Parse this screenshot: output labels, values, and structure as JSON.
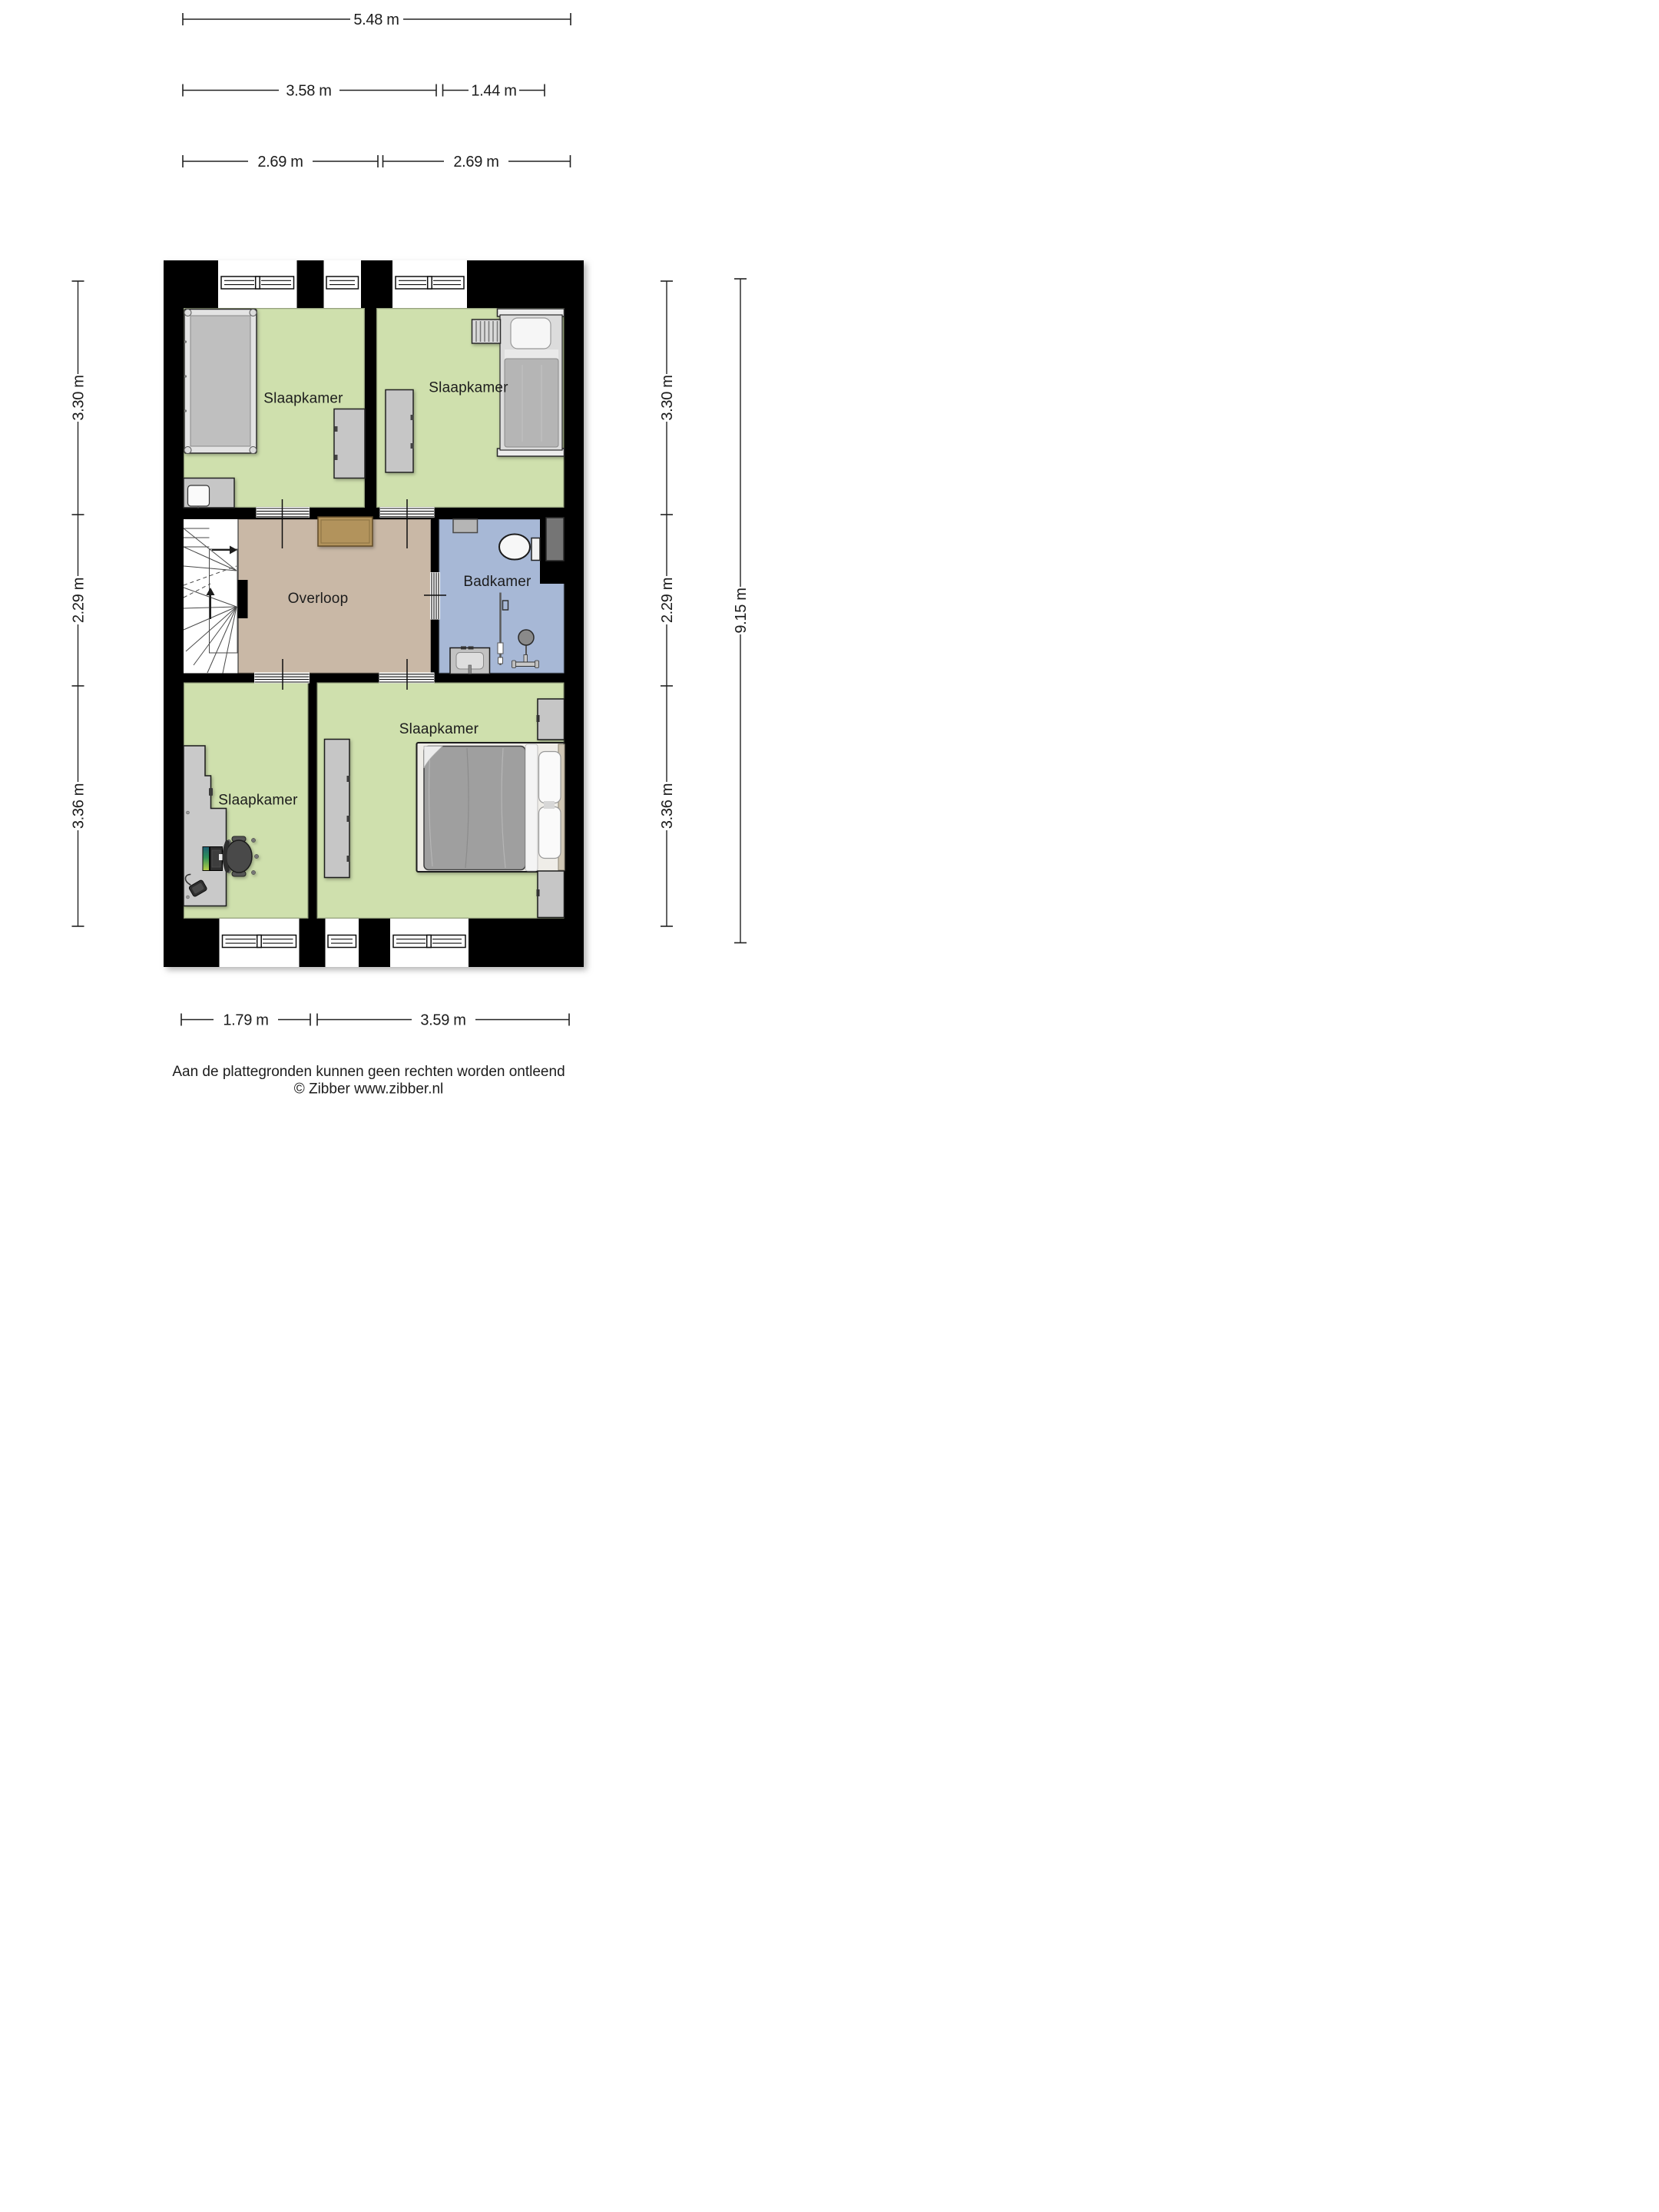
{
  "dimensions": {
    "overall_top": "5.48 m",
    "top_left": "3.58 m",
    "top_right": "1.44 m",
    "mid_left": "2.69 m",
    "mid_right": "2.69 m",
    "side_left": [
      "3.30 m",
      "2.29 m",
      "3.36 m"
    ],
    "side_right": [
      "3.30 m",
      "2.29 m",
      "3.36 m"
    ],
    "overall_right": "9.15 m",
    "bottom_left": "1.79 m",
    "bottom_right": "3.59 m"
  },
  "rooms": {
    "bedroom_top_left": "Slaapkamer",
    "bedroom_top_right": "Slaapkamer",
    "landing": "Overloop",
    "bathroom": "Badkamer",
    "bedroom_bottom_left": "Slaapkamer",
    "bedroom_bottom_right": "Slaapkamer"
  },
  "footer": {
    "disclaimer": "Aan de plattegronden kunnen geen rechten worden ontleend",
    "copyright": "© Zibber www.zibber.nl"
  },
  "colors": {
    "wall": "#000000",
    "bedroom_floor": "#cfe0ad",
    "landing_floor": "#c9b8a6",
    "bathroom_floor": "#a7b8d6",
    "stairs": "#ffffff",
    "wood_cabinet": "#b2935c",
    "furniture_gray": "#c6c6c6"
  }
}
